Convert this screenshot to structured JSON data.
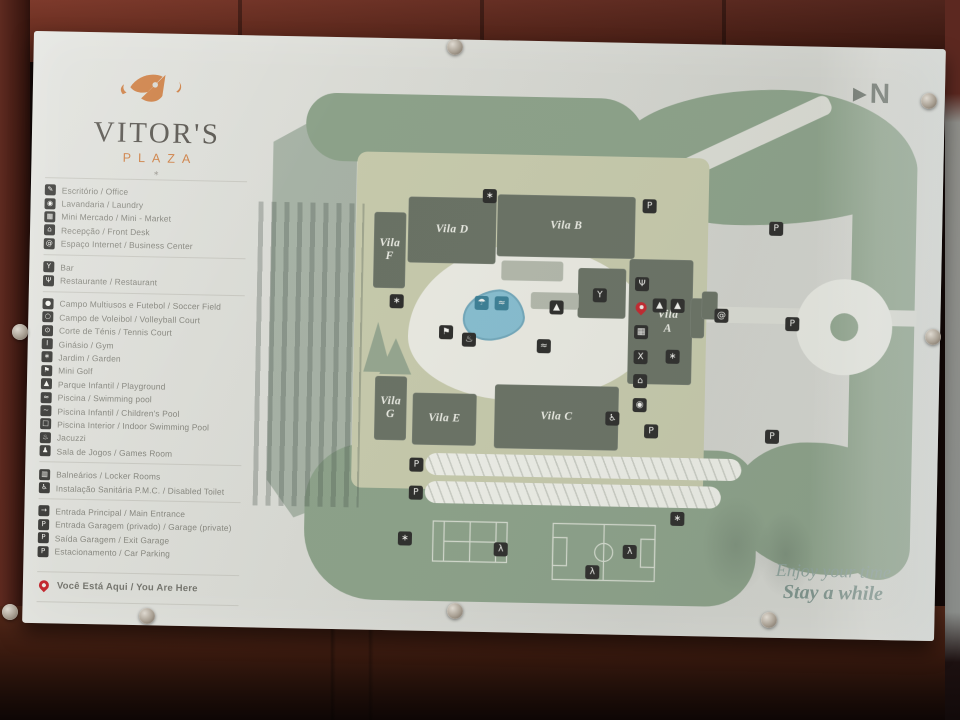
{
  "scene": {
    "description": "Photographed wall-mounted resort site-map sign behind glass"
  },
  "brand": {
    "name": "VITOR'S",
    "subtitle": "PLAZA",
    "mark": "∗"
  },
  "compass": {
    "arrow": "▶",
    "label": "N"
  },
  "tagline": {
    "line1": "Enjoy your time",
    "line2": "Stay a while"
  },
  "colors": {
    "accent_orange": "#cd7f44",
    "pin_red": "#c2272e",
    "sage_green": "#8ca189",
    "olive": "#c6c9ab",
    "building_gray": "#697164",
    "pond_blue": "#86bdcf",
    "panel_gray": "#d8d9d3"
  },
  "legend": {
    "groups": [
      {
        "items": [
          {
            "name": "office",
            "glyph": "✎",
            "label": "Escritório / Office"
          },
          {
            "name": "laundry",
            "glyph": "◉",
            "label": "Lavandaria / Laundry"
          },
          {
            "name": "mini-market",
            "glyph": "▦",
            "label": "Mini Mercado / Mini - Market"
          },
          {
            "name": "front-desk",
            "glyph": "⌂",
            "label": "Recepção / Front Desk"
          },
          {
            "name": "internet",
            "glyph": "@",
            "label": "Espaço Internet / Business Center"
          }
        ]
      },
      {
        "items": [
          {
            "name": "bar",
            "glyph": "Y",
            "label": "Bar"
          },
          {
            "name": "restaurant",
            "glyph": "Ψ",
            "label": "Restaurante / Restaurant"
          }
        ]
      },
      {
        "items": [
          {
            "name": "soccer-field",
            "glyph": "●",
            "label": "Campo Multiusos e Futebol / Soccer Field"
          },
          {
            "name": "volleyball-court",
            "glyph": "○",
            "label": "Campo de Voleibol / Volleyball Court"
          },
          {
            "name": "tennis-court",
            "glyph": "⊙",
            "label": "Corte de Ténis / Tennis Court"
          },
          {
            "name": "gym",
            "glyph": "I",
            "label": "Ginásio / Gym"
          },
          {
            "name": "garden",
            "glyph": "∗",
            "label": "Jardim / Garden"
          },
          {
            "name": "mini-golf",
            "glyph": "⚑",
            "label": "Mini Golf"
          },
          {
            "name": "playground",
            "glyph": "▲",
            "label": "Parque Infantil / Playground"
          },
          {
            "name": "pool",
            "glyph": "≈",
            "label": "Piscina / Swimming pool"
          },
          {
            "name": "children-pool",
            "glyph": "∼",
            "label": "Piscina Infantil / Children's Pool"
          },
          {
            "name": "indoor-pool",
            "glyph": "□",
            "label": "Piscina Interior / Indoor Swimming Pool"
          },
          {
            "name": "jacuzzi",
            "glyph": "♨",
            "label": "Jacuzzi"
          },
          {
            "name": "games-room",
            "glyph": "♟",
            "label": "Sala de Jogos / Games Room"
          }
        ]
      },
      {
        "items": [
          {
            "name": "locker-rooms",
            "glyph": "▥",
            "label": "Balneários / Locker Rooms"
          },
          {
            "name": "disabled-toilet",
            "glyph": "♿",
            "label": "Instalação Sanitária P.M.C. / Disabled Toilet"
          }
        ]
      },
      {
        "items": [
          {
            "name": "main-entrance",
            "glyph": "→",
            "label": "Entrada Principal / Main Entrance"
          },
          {
            "name": "garage-entrance",
            "glyph": "P",
            "label": "Entrada Garagem (privado) / Garage (private)"
          },
          {
            "name": "garage-exit",
            "glyph": "P",
            "label": "Saída Garagem / Exit Garage"
          },
          {
            "name": "car-parking",
            "glyph": "P",
            "label": "Estacionamento / Car Parking"
          }
        ]
      }
    ],
    "you_are_here": {
      "label": "Você Está Aqui / You Are Here"
    }
  },
  "map": {
    "buildings": [
      {
        "name": "building-vila-f",
        "label": "Vila F",
        "stack": true,
        "x": 344,
        "y": 174,
        "w": 32,
        "h": 76
      },
      {
        "name": "building-vila-d",
        "label": "Vila D",
        "x": 378,
        "y": 158,
        "w": 88,
        "h": 66
      },
      {
        "name": "building-vila-b",
        "label": "Vila B",
        "x": 467,
        "y": 154,
        "w": 138,
        "h": 62
      },
      {
        "name": "building-bar",
        "x": 549,
        "y": 226,
        "w": 48,
        "h": 50
      },
      {
        "name": "building-spa",
        "x": 472,
        "y": 220,
        "w": 62,
        "h": 20,
        "variant": "light"
      },
      {
        "name": "building-pavilion",
        "x": 502,
        "y": 251,
        "w": 48,
        "h": 17,
        "variant": "light"
      },
      {
        "name": "building-vila-a",
        "label": "Vila A",
        "stack": true,
        "x": 600,
        "y": 216,
        "w": 64,
        "h": 125
      },
      {
        "name": "building-vila-a-annex",
        "x": 662,
        "y": 254,
        "w": 14,
        "h": 40
      },
      {
        "name": "building-east",
        "x": 673,
        "y": 247,
        "w": 16,
        "h": 28
      },
      {
        "name": "building-vila-c",
        "label": "Vila C",
        "x": 468,
        "y": 344,
        "w": 124,
        "h": 64
      },
      {
        "name": "building-vila-e",
        "label": "Vila E",
        "x": 386,
        "y": 354,
        "w": 64,
        "h": 52
      },
      {
        "name": "building-vila-g",
        "label": "Vila G",
        "stack": true,
        "x": 348,
        "y": 338,
        "w": 32,
        "h": 64
      }
    ],
    "markers": [
      {
        "name": "garden-icon-1",
        "glyph": "∗",
        "x": 452,
        "y": 149
      },
      {
        "name": "garage-entrance-icon",
        "glyph": "P",
        "x": 612,
        "y": 156
      },
      {
        "name": "parking-icon-1",
        "glyph": "P",
        "x": 739,
        "y": 176
      },
      {
        "name": "bar-icon",
        "glyph": "Y",
        "x": 564,
        "y": 246
      },
      {
        "name": "restaurant-icon",
        "glyph": "Ψ",
        "x": 606,
        "y": 234
      },
      {
        "name": "you-are-here-pin",
        "glyph": "",
        "x": 606,
        "y": 258,
        "variant": "pin"
      },
      {
        "name": "slide-icon-1",
        "glyph": "▲",
        "x": 624,
        "y": 255
      },
      {
        "name": "slide-icon-2",
        "glyph": "▲",
        "x": 642,
        "y": 255
      },
      {
        "name": "mini-market-icon",
        "glyph": "▦",
        "x": 606,
        "y": 282
      },
      {
        "name": "gym-icon",
        "glyph": "X",
        "x": 606,
        "y": 307
      },
      {
        "name": "front-desk-icon",
        "glyph": "⌂",
        "x": 606,
        "y": 331
      },
      {
        "name": "laundry-icon",
        "glyph": "◉",
        "x": 606,
        "y": 355
      },
      {
        "name": "garden-icon-2",
        "glyph": "∗",
        "x": 638,
        "y": 306
      },
      {
        "name": "internet-icon",
        "glyph": "@",
        "x": 686,
        "y": 264
      },
      {
        "name": "parking-icon-2",
        "glyph": "P",
        "x": 757,
        "y": 271
      },
      {
        "name": "garden-icon-3",
        "glyph": "∗",
        "x": 361,
        "y": 256
      },
      {
        "name": "mini-golf-icon",
        "glyph": "⚑",
        "x": 411,
        "y": 286
      },
      {
        "name": "sun-lounger-icon",
        "glyph": "☂",
        "x": 446,
        "y": 256,
        "variant": "teal"
      },
      {
        "name": "swimmer-icon-1",
        "glyph": "≈",
        "x": 466,
        "y": 256,
        "variant": "teal"
      },
      {
        "name": "fountain-icon",
        "glyph": "♨",
        "x": 434,
        "y": 293
      },
      {
        "name": "swimmer-icon-2",
        "glyph": "≈",
        "x": 509,
        "y": 298
      },
      {
        "name": "playground-icon",
        "glyph": "▲",
        "x": 521,
        "y": 259
      },
      {
        "name": "disabled-access-icon",
        "glyph": "♿",
        "x": 579,
        "y": 369
      },
      {
        "name": "parking-icon-3",
        "glyph": "P",
        "x": 739,
        "y": 384
      },
      {
        "name": "garage-exit-icon",
        "glyph": "P",
        "x": 618,
        "y": 381
      },
      {
        "name": "parking-icon-4",
        "glyph": "P",
        "x": 384,
        "y": 419
      },
      {
        "name": "parking-icon-5",
        "glyph": "P",
        "x": 384,
        "y": 447
      },
      {
        "name": "garden-icon-4",
        "glyph": "∗",
        "x": 374,
        "y": 493
      },
      {
        "name": "tennis-player-icon",
        "glyph": "λ",
        "x": 470,
        "y": 502
      },
      {
        "name": "soccer-player-icon",
        "glyph": "λ",
        "x": 599,
        "y": 502
      },
      {
        "name": "volleyball-player-icon",
        "glyph": "λ",
        "x": 562,
        "y": 523
      },
      {
        "name": "garden-icon-5",
        "glyph": "∗",
        "x": 646,
        "y": 468
      }
    ],
    "fields": [
      {
        "name": "tennis-court"
      },
      {
        "name": "soccer-field"
      }
    ]
  }
}
